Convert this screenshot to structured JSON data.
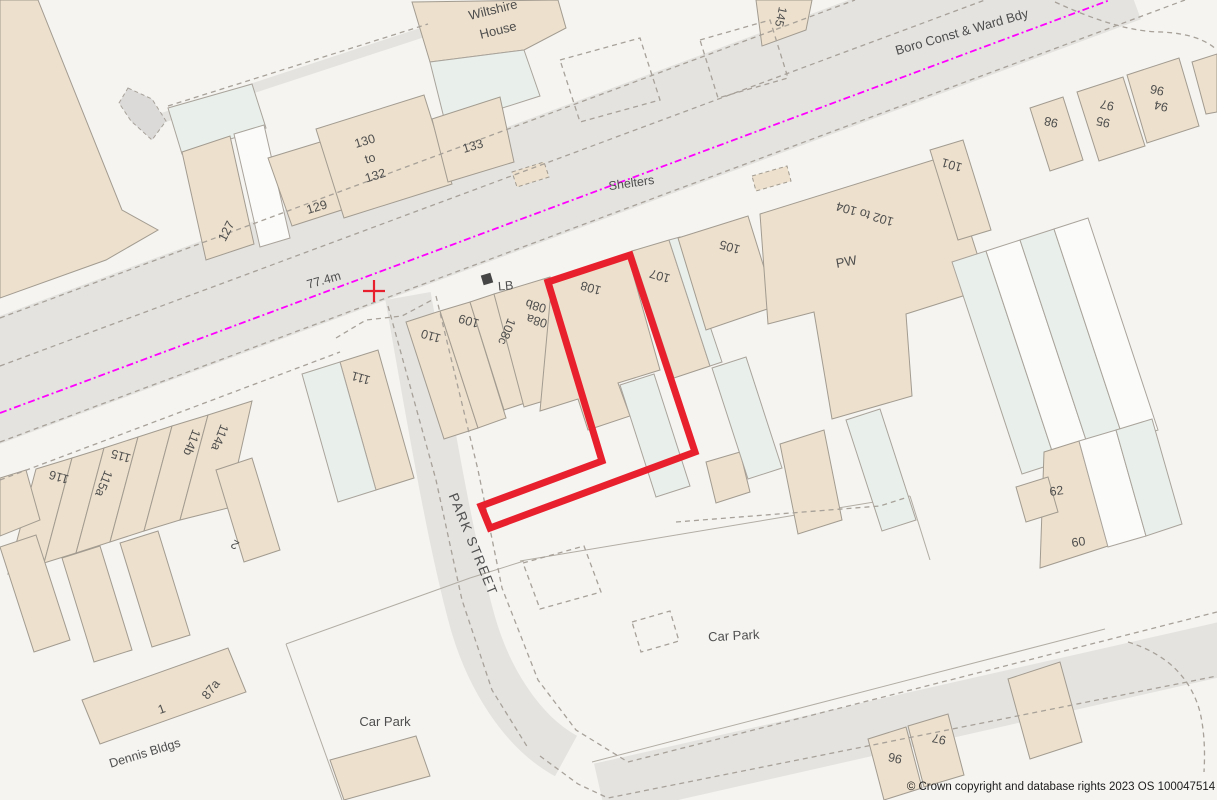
{
  "map": {
    "copyright": "© Crown copyright and database rights 2023 OS 100047514",
    "colors": {
      "site_outline_red": "#e8202e",
      "ward_boundary_magenta": "#ff00ff",
      "building_tan": "#ede0cc",
      "building_outline": "#a29b90",
      "road_grey": "#e4e3e0",
      "background": "#f5f4f1",
      "label_grey": "#4e4e4e"
    },
    "site_outline": {
      "points": "548,282 630,255 695,452 490,528 481,506 602,461",
      "color": "#e8202e",
      "stroke_width": 7
    },
    "ward_boundary": {
      "x1": 0,
      "y1": 413,
      "x2": 1110,
      "y2": 0,
      "color": "#ff00ff"
    },
    "survey_cross": {
      "x": 374,
      "y": 291,
      "arm": 11,
      "color": "#e8202e"
    },
    "labels": [
      {
        "id": "wiltshire-house",
        "lines": [
          "Wiltshire",
          "House"
        ],
        "lh": 21,
        "x": 494,
        "y": 14,
        "rot": -14,
        "size": 13
      },
      {
        "id": "no-145",
        "text": "145",
        "x": 777,
        "y": 16,
        "rot": 102,
        "size": 12
      },
      {
        "id": "boro-const-ward-bdy",
        "text": "Boro Const & Ward Bdy",
        "x": 963,
        "y": 36,
        "rot": -16,
        "size": 13
      },
      {
        "id": "shelters",
        "text": "Shelters",
        "x": 632,
        "y": 187,
        "rot": -8,
        "size": 12.5
      },
      {
        "id": "no-130-132",
        "lines": [
          "130",
          "to",
          "132"
        ],
        "lh": 18,
        "x": 366,
        "y": 145,
        "rot": -17,
        "size": 12.5
      },
      {
        "id": "no-133",
        "text": "133",
        "x": 474,
        "y": 150,
        "rot": -17,
        "size": 12.5
      },
      {
        "id": "no-129",
        "text": "129",
        "x": 318,
        "y": 211,
        "rot": -17,
        "size": 12.5
      },
      {
        "id": "no-127",
        "text": "127",
        "x": 230,
        "y": 233,
        "rot": -63,
        "size": 12.5
      },
      {
        "id": "bench-mark",
        "text": "77.4m",
        "x": 325,
        "y": 284,
        "rot": -16,
        "size": 12.5
      },
      {
        "id": "lb",
        "text": "LB",
        "x": 506,
        "y": 290,
        "rot": -5,
        "size": 12.5
      },
      {
        "id": "no-110",
        "text": "110",
        "x": 432,
        "y": 332,
        "rot": 196,
        "size": 12.5
      },
      {
        "id": "no-109",
        "text": "109",
        "x": 470,
        "y": 317,
        "rot": 196,
        "size": 12.5
      },
      {
        "id": "no-108c",
        "text": "108c",
        "x": 503,
        "y": 330,
        "rot": 112,
        "size": 12.5
      },
      {
        "id": "no-08b",
        "text": "08b",
        "x": 537,
        "y": 302,
        "rot": 196,
        "size": 12.5
      },
      {
        "id": "no-08a",
        "text": "08a",
        "x": 538,
        "y": 317,
        "rot": 196,
        "size": 12.5
      },
      {
        "id": "no-108",
        "text": "108",
        "x": 592,
        "y": 284,
        "rot": 196,
        "size": 12.5
      },
      {
        "id": "no-107",
        "text": "107",
        "x": 661,
        "y": 272,
        "rot": 196,
        "size": 12.5
      },
      {
        "id": "no-105",
        "text": "105",
        "x": 731,
        "y": 243,
        "rot": 196,
        "size": 12.5
      },
      {
        "id": "pw",
        "text": "PW",
        "x": 847,
        "y": 266,
        "rot": -10,
        "size": 13
      },
      {
        "id": "no-102-104",
        "text": "102 to 104",
        "x": 866,
        "y": 210,
        "rot": 196,
        "size": 12.5
      },
      {
        "id": "no-101",
        "text": "101",
        "x": 953,
        "y": 161,
        "rot": 196,
        "size": 12.5
      },
      {
        "id": "no-98",
        "text": "98",
        "x": 1052,
        "y": 118,
        "rot": 192,
        "size": 12.5
      },
      {
        "id": "no-97",
        "text": "97",
        "x": 1108,
        "y": 101,
        "rot": 192,
        "size": 12.5
      },
      {
        "id": "no-95",
        "text": "95",
        "x": 1104,
        "y": 118,
        "rot": 192,
        "size": 12.5
      },
      {
        "id": "no-94",
        "text": "94",
        "x": 1162,
        "y": 102,
        "rot": 192,
        "size": 12.5
      },
      {
        "id": "no-96",
        "text": "96",
        "x": 1158,
        "y": 86,
        "rot": 192,
        "size": 12.5
      },
      {
        "id": "no-111",
        "text": "111",
        "x": 362,
        "y": 374,
        "rot": 196,
        "size": 12.5
      },
      {
        "id": "no-114a",
        "text": "114a",
        "x": 216,
        "y": 436,
        "rot": 112,
        "size": 12.5
      },
      {
        "id": "no-114b",
        "text": "114b",
        "x": 188,
        "y": 441,
        "rot": 112,
        "size": 12.5
      },
      {
        "id": "no-115",
        "text": "115",
        "x": 122,
        "y": 452,
        "rot": 196,
        "size": 12.5
      },
      {
        "id": "no-115a",
        "text": "115a",
        "x": 100,
        "y": 482,
        "rot": 112,
        "size": 12.5
      },
      {
        "id": "no-116",
        "text": "116",
        "x": 60,
        "y": 473,
        "rot": 196,
        "size": 12.5
      },
      {
        "id": "no-2",
        "text": "2",
        "x": 237,
        "y": 541,
        "rot": 210,
        "size": 12.5
      },
      {
        "id": "park-street",
        "text": "PARK STREET",
        "x": 469,
        "y": 546,
        "rot": 68,
        "size": 13.5,
        "ls": 1.5
      },
      {
        "id": "no-62",
        "text": "62",
        "x": 1057,
        "y": 495,
        "rot": -8,
        "size": 12.5
      },
      {
        "id": "no-60",
        "text": "60",
        "x": 1079,
        "y": 546,
        "rot": -8,
        "size": 12.5
      },
      {
        "id": "car-park-east",
        "text": "Car Park",
        "x": 734,
        "y": 640,
        "rot": -3,
        "size": 13
      },
      {
        "id": "car-park-west",
        "text": "Car Park",
        "x": 385,
        "y": 726,
        "rot": 0,
        "size": 13
      },
      {
        "id": "dennis-bldgs",
        "text": "Dennis Bldgs",
        "x": 146,
        "y": 757,
        "rot": -17,
        "size": 12.5
      },
      {
        "id": "no-1",
        "text": "1",
        "x": 163,
        "y": 713,
        "rot": -20,
        "size": 12.5
      },
      {
        "id": "no-87a",
        "text": "87a",
        "x": 214,
        "y": 692,
        "rot": -52,
        "size": 12.5
      },
      {
        "id": "no-96-south",
        "text": "96",
        "x": 896,
        "y": 754,
        "rot": 192,
        "size": 12.5
      },
      {
        "id": "no-97-south",
        "text": "97",
        "x": 940,
        "y": 735,
        "rot": 192,
        "size": 12.5
      }
    ]
  }
}
